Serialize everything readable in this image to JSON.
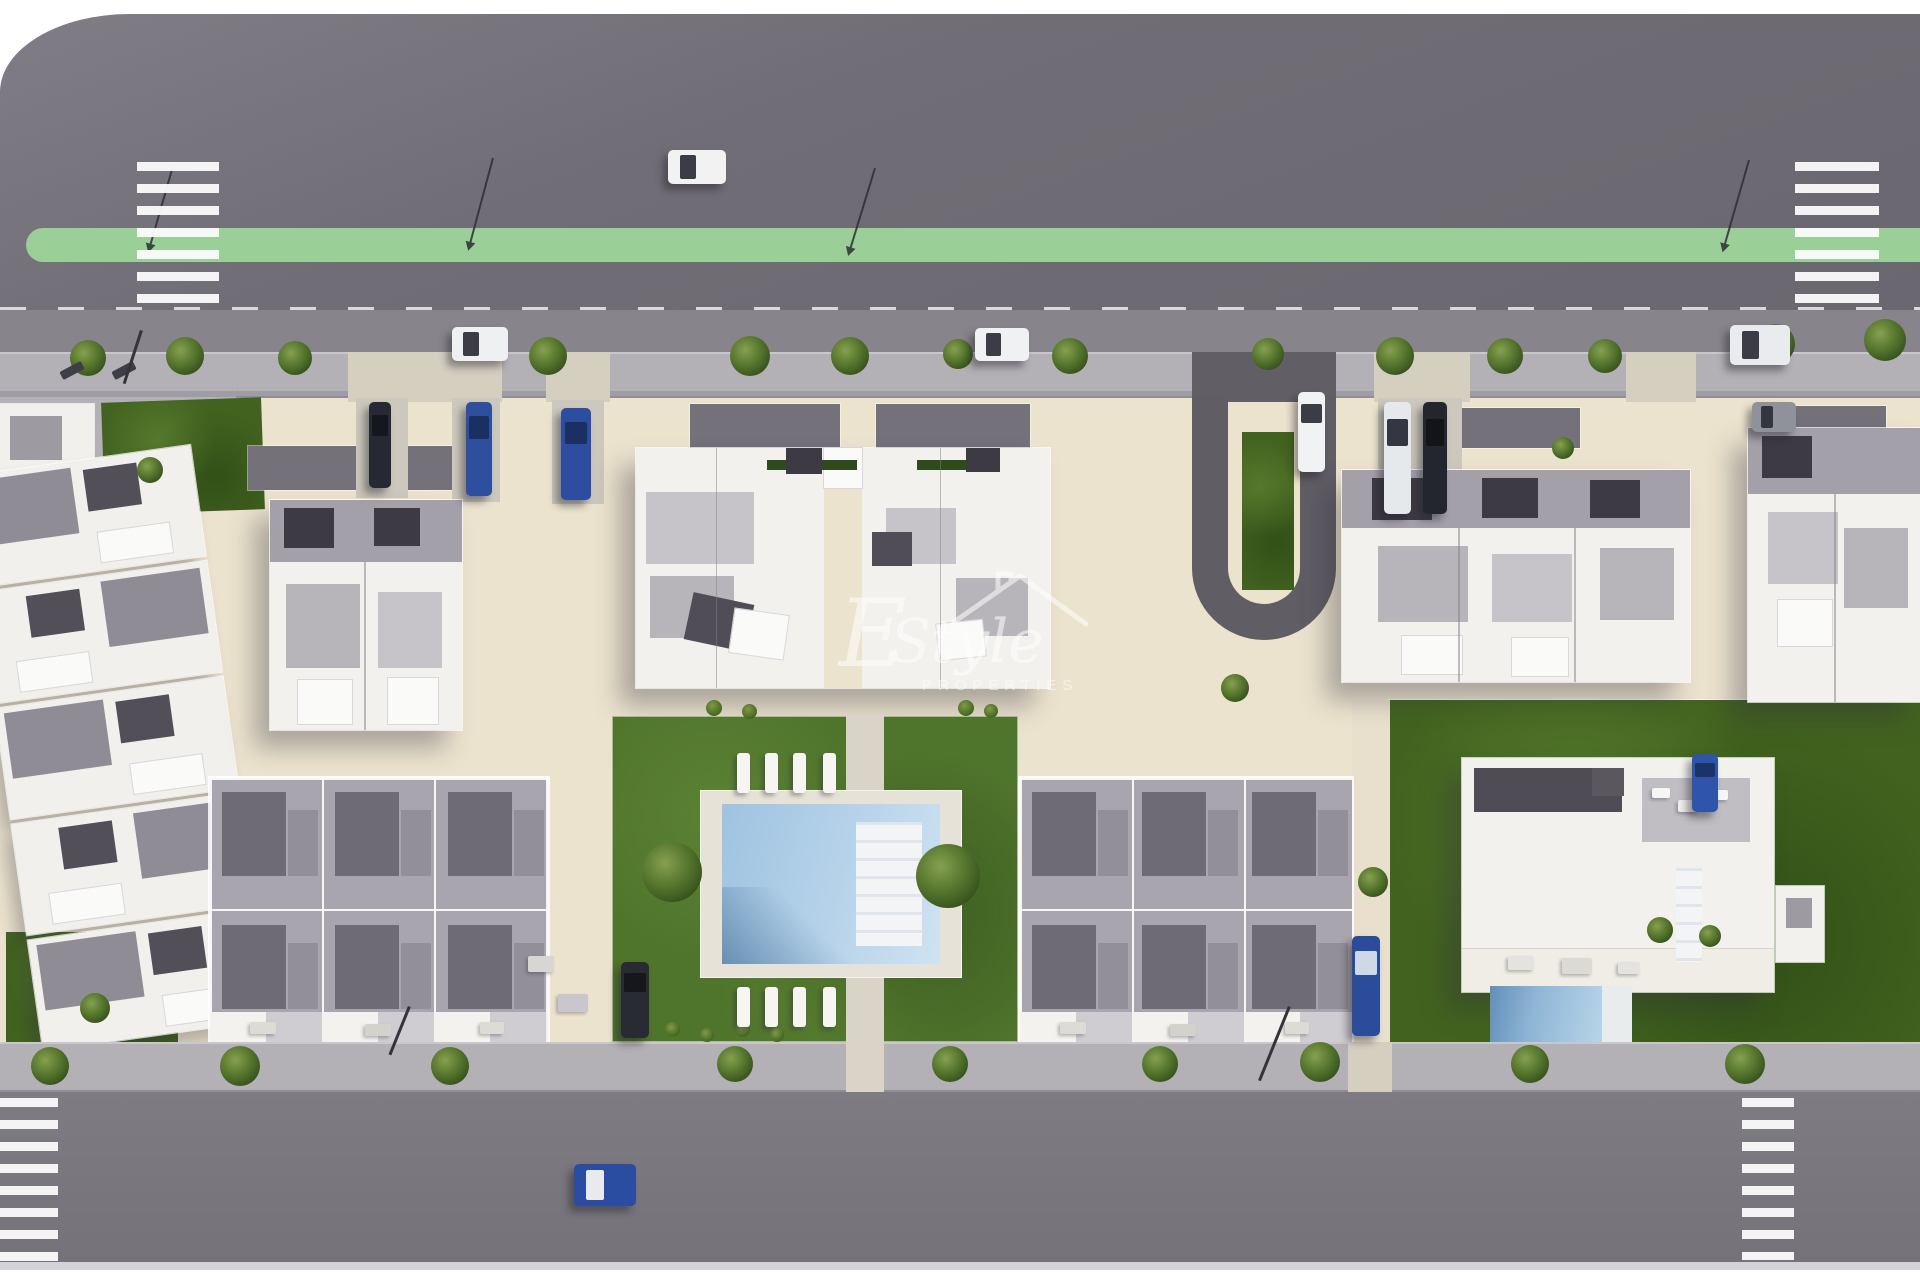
{
  "meta": {
    "description": "Aerial 3D architectural render of a residential development site plan with apartment blocks, townhouse rows, a communal pool garden, a detached villa, tree-lined streets, crosswalks and parked cars",
    "image_type": "architectural-render"
  },
  "watermark": {
    "flourish": "E",
    "script": "Style",
    "caps": "PROPERTIES"
  },
  "palette": {
    "road_top": "#6d6972",
    "road_bottom": "#7a777e",
    "green_median": "#9bcf98",
    "sidewalk": "#b3b1b6",
    "parking_lane": "#87848b",
    "plot_beige": "#ece3ce",
    "lawn_dark": "#42631f",
    "garden_green": "#4f742c",
    "pool_water": "#aecbe4",
    "building_white": "#f2f1ee",
    "roof_gray": "#8f8c95",
    "roof_dark": "#504d56",
    "car_blue": "#2e4f9e",
    "crosswalk_white": "#fcfcfc"
  },
  "scene": {
    "counts": {
      "apartment_buildings": 5,
      "townhouse_rows": 3,
      "villas": 1,
      "communal_pools": 1,
      "private_pools": 1,
      "crosswalks": 4,
      "cars": 15
    },
    "sprites": {
      "trees": [
        [
          88,
          358,
          36
        ],
        [
          185,
          356,
          38
        ],
        [
          295,
          358,
          34
        ],
        [
          548,
          356,
          38
        ],
        [
          750,
          356,
          40
        ],
        [
          850,
          356,
          38
        ],
        [
          958,
          354,
          30
        ],
        [
          1070,
          356,
          36
        ],
        [
          1268,
          354,
          32
        ],
        [
          1395,
          356,
          38
        ],
        [
          1505,
          356,
          36
        ],
        [
          1605,
          356,
          34
        ],
        [
          1775,
          344,
          40
        ],
        [
          1885,
          340,
          42
        ],
        [
          50,
          1066,
          38
        ],
        [
          240,
          1066,
          40
        ],
        [
          450,
          1066,
          38
        ],
        [
          735,
          1064,
          36
        ],
        [
          950,
          1064,
          36
        ],
        [
          1160,
          1064,
          36
        ],
        [
          1320,
          1062,
          40
        ],
        [
          1530,
          1064,
          38
        ],
        [
          1745,
          1064,
          40
        ],
        [
          672,
          872,
          60
        ],
        [
          948,
          876,
          64
        ],
        [
          150,
          470,
          26
        ],
        [
          95,
          1008,
          30
        ],
        [
          1235,
          688,
          28
        ],
        [
          1373,
          882,
          30
        ],
        [
          1660,
          930,
          26
        ],
        [
          1710,
          936,
          22
        ],
        [
          1563,
          448,
          22
        ]
      ],
      "shrubs": [
        [
          706,
          700,
          16
        ],
        [
          742,
          704,
          15
        ],
        [
          958,
          700,
          16
        ],
        [
          984,
          704,
          14
        ],
        [
          665,
          1022,
          15
        ],
        [
          700,
          1028,
          14
        ],
        [
          735,
          1022,
          15
        ],
        [
          770,
          1028,
          14
        ]
      ],
      "loungers": [
        [
          737,
          753
        ],
        [
          765,
          753
        ],
        [
          793,
          753
        ],
        [
          823,
          753
        ],
        [
          737,
          987
        ],
        [
          765,
          987
        ],
        [
          793,
          987
        ],
        [
          823,
          987
        ]
      ],
      "furniture": [
        [
          528,
          956,
          26,
          16,
          "#d8d6d2"
        ],
        [
          558,
          994,
          30,
          18,
          "#c9c7cd"
        ],
        [
          250,
          1022,
          26,
          12,
          "#dddbd6"
        ],
        [
          365,
          1024,
          26,
          12,
          "#d4d2cd"
        ],
        [
          480,
          1022,
          24,
          12,
          "#dddbd6"
        ],
        [
          1060,
          1022,
          26,
          12,
          "#dddbd6"
        ],
        [
          1170,
          1024,
          26,
          12,
          "#d4d2cd"
        ],
        [
          1285,
          1022,
          24,
          12,
          "#dddbd6"
        ],
        [
          1508,
          956,
          26,
          14,
          "#e5e3df"
        ],
        [
          1562,
          958,
          30,
          16,
          "#dcdad5"
        ],
        [
          1618,
          962,
          22,
          12,
          "#e5e3df"
        ],
        [
          1652,
          788,
          18,
          10,
          "#f6f6f4"
        ],
        [
          1678,
          800,
          20,
          12,
          "#eeeeec"
        ],
        [
          1712,
          790,
          16,
          10,
          "#f6f6f4"
        ]
      ],
      "benches": [
        [
          60,
          366
        ],
        [
          112,
          366
        ]
      ],
      "poles": [
        [
          140,
          330,
          56,
          18
        ],
        [
          408,
          1006,
          52,
          22
        ],
        [
          1288,
          1006,
          80,
          22
        ]
      ],
      "cars": [
        {
          "x": 668,
          "y": 150,
          "w": 58,
          "h": 34,
          "c": "#f2f2f3",
          "g": "#3c3c46",
          "label": "white car on avenue"
        },
        {
          "x": 452,
          "y": 327,
          "w": 56,
          "h": 34,
          "c": "#eef0f2",
          "g": "#3c3c46",
          "label": "white car parked"
        },
        {
          "x": 975,
          "y": 328,
          "w": 54,
          "h": 33,
          "c": "#f0f1f3",
          "g": "#3c3c46",
          "label": "white car parked"
        },
        {
          "x": 1730,
          "y": 325,
          "w": 60,
          "h": 40,
          "c": "#e9ebee",
          "g": "#3c3c46",
          "label": "white suv parked"
        },
        {
          "x": 1752,
          "y": 402,
          "w": 44,
          "h": 30,
          "c": "#8f929a",
          "g": "#33363e",
          "label": "gray car"
        },
        {
          "x": 369,
          "y": 402,
          "w": 22,
          "h": 86,
          "c": "#262933",
          "g": "#15171e",
          "label": "dark van in driveway"
        },
        {
          "x": 466,
          "y": 402,
          "w": 26,
          "h": 94,
          "c": "#2e4f9e",
          "g": "#1b2f63",
          "label": "blue car in driveway"
        },
        {
          "x": 561,
          "y": 408,
          "w": 30,
          "h": 92,
          "c": "#2c4da0",
          "g": "#1b2f63",
          "label": "blue car in driveway"
        },
        {
          "x": 1298,
          "y": 392,
          "w": 27,
          "h": 80,
          "c": "#f1f2f4",
          "g": "#3c3c46",
          "label": "white car on loop drive"
        },
        {
          "x": 1384,
          "y": 402,
          "w": 27,
          "h": 112,
          "c": "#e6e9ec",
          "g": "#343741",
          "label": "white van"
        },
        {
          "x": 1423,
          "y": 402,
          "w": 24,
          "h": 112,
          "c": "#23262e",
          "g": "#12141a",
          "label": "dark van"
        },
        {
          "x": 1352,
          "y": 936,
          "w": 28,
          "h": 100,
          "c": "#2b4c9b",
          "g": "#cfd8e6",
          "label": "blue car in lane"
        },
        {
          "x": 1692,
          "y": 754,
          "w": 26,
          "h": 58,
          "c": "#2e55aa",
          "g": "#1c3366",
          "label": "blue car at villa"
        },
        {
          "x": 621,
          "y": 962,
          "w": 28,
          "h": 76,
          "c": "#282b33",
          "g": "#15171d",
          "label": "dark car at garden"
        },
        {
          "x": 574,
          "y": 1164,
          "w": 62,
          "h": 42,
          "c": "#2a4da1",
          "g": "#e8eaee",
          "label": "blue car with white roof on south road"
        }
      ]
    }
  }
}
